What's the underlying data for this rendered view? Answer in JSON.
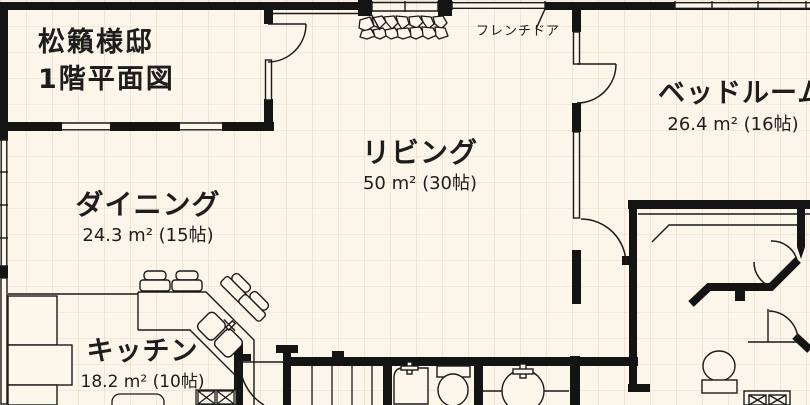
{
  "plan": {
    "title_block": {
      "owner": "松籟様邸",
      "floor": "1階平面図"
    },
    "labels": {
      "french_door": "フレンチドア"
    },
    "rooms": {
      "living": {
        "name": "リビング",
        "size": "50 m² (30帖)"
      },
      "dining": {
        "name": "ダイニング",
        "size": "24.3 m² (15帖)"
      },
      "bedroom": {
        "name": "ベッドルーム",
        "size": "26.4 m² (16帖)"
      },
      "kitchen": {
        "name": "キッチン",
        "size": "18.2 m² (10帖)"
      }
    },
    "colors": {
      "background": "#FCF5E9",
      "grid": "#E8DCC8",
      "wall": "#141414",
      "line": "#1A1A1A",
      "fixture_fill": "#FDF7EB",
      "text": "#1D1D1D"
    }
  }
}
